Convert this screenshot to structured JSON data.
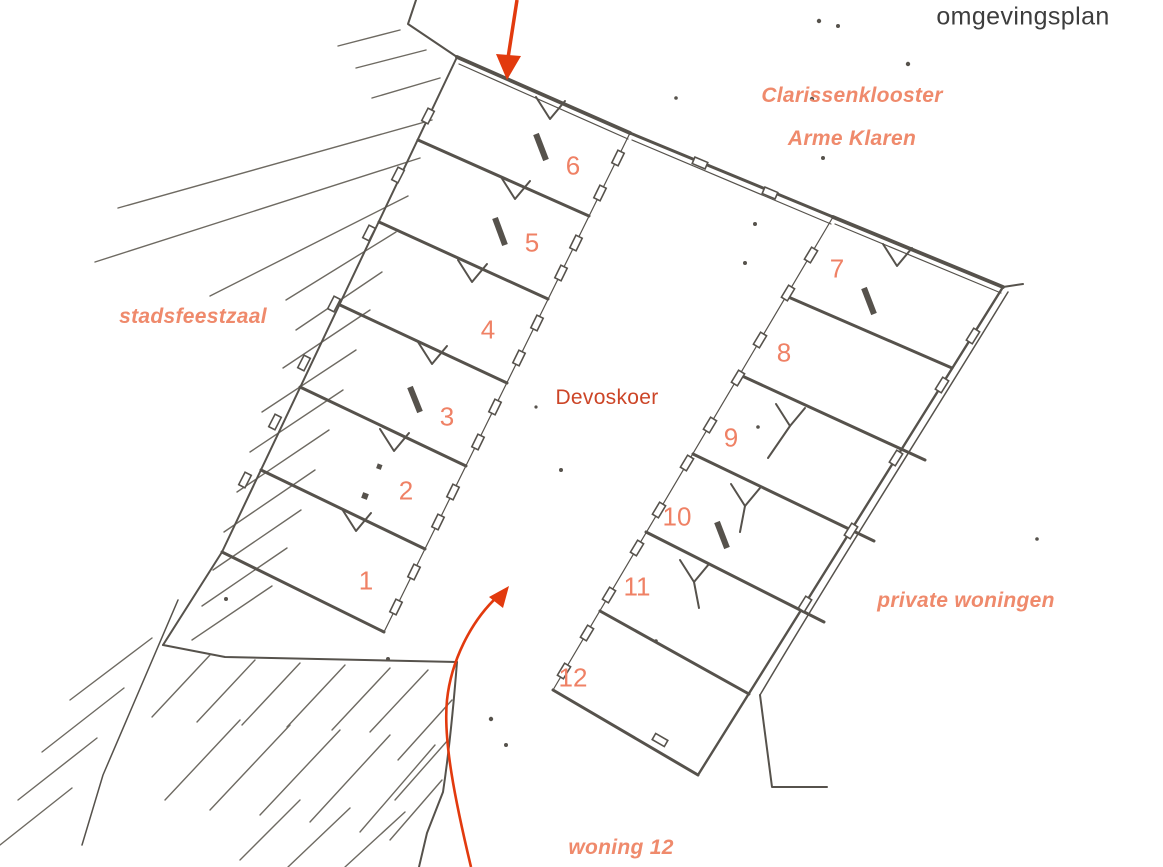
{
  "title": "omgevingsplan",
  "labels": {
    "klooster_line1": "Clarissenklooster",
    "klooster_line2": "Arme Klaren",
    "stadsfeestzaal": "stadsfeestzaal",
    "courtyard": "Devoskoer",
    "private_woningen": "private woningen",
    "woning12": "woning 12"
  },
  "room_numbers": [
    "1",
    "2",
    "3",
    "4",
    "5",
    "6",
    "7",
    "8",
    "9",
    "10",
    "11",
    "12"
  ],
  "colors": {
    "label_salmon": "#ef8a6c",
    "number_salmon": "#ef8165",
    "courtyard_red": "#cc4527",
    "arrow_red": "#e23a0e",
    "ink": "#56524c",
    "hatch_gray": "#6e6a62",
    "title_gray": "#3d3d3d"
  }
}
